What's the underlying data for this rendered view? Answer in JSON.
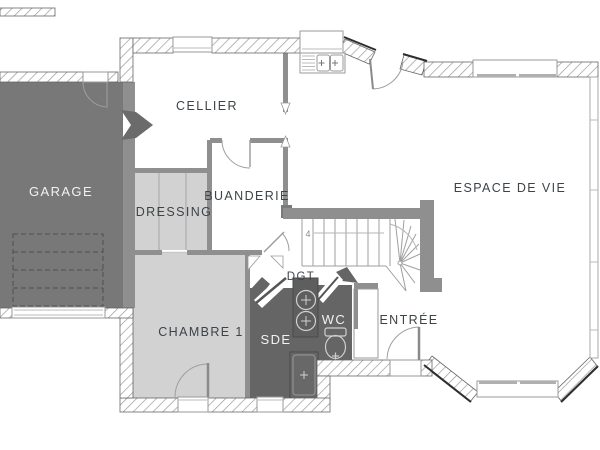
{
  "plan": {
    "type": "floor-plan",
    "rooms": {
      "garage": {
        "label": "GARAGE"
      },
      "cellier": {
        "label": "CELLIER"
      },
      "dressing": {
        "label": "DRESSING"
      },
      "buanderie": {
        "label": "BUANDERIE"
      },
      "espace_de_vie": {
        "label": "ESPACE DE VIE"
      },
      "chambre1": {
        "label": "CHAMBRE 1"
      },
      "dgt": {
        "label": "DGT"
      },
      "sde": {
        "label": "SDE"
      },
      "wc": {
        "label": "WC"
      },
      "entree": {
        "label": "ENTRÉE"
      }
    },
    "stairs": {
      "step_number_label": "4"
    },
    "colors": {
      "garage_fill": "#787878",
      "wet_room_fill": "#656565",
      "light_room_fill": "#d2d2d2",
      "interior_wall": "#8f8f8f",
      "label_dark": "#3e4347",
      "label_light": "#f2f2f2",
      "wall_edge": "#2e2e2e"
    }
  }
}
